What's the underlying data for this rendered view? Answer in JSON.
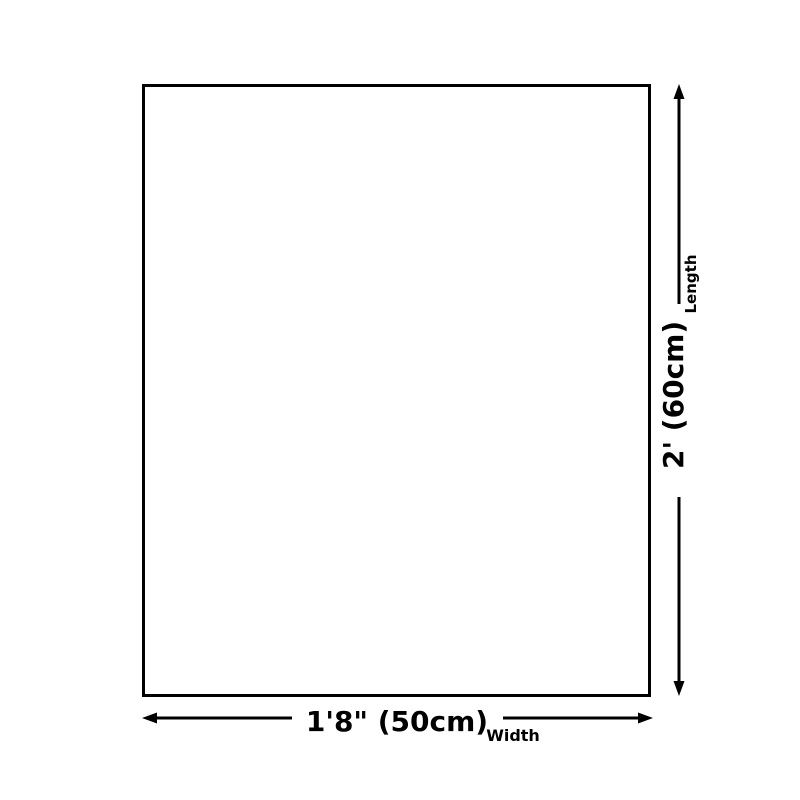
{
  "page": {
    "background_color": "#ffffff"
  },
  "diagram": {
    "type": "product-dimension-diagram",
    "line_color": "#000000",
    "shape": {
      "kind": "rectangle",
      "fill": "#ffffff",
      "border_color": "#000000"
    },
    "length_dimension": {
      "label": "Length",
      "value": "2' (60cm)",
      "orientation": "vertical"
    },
    "width_dimension": {
      "label": "Width",
      "value": "1'8\" (50cm)",
      "orientation": "horizontal"
    }
  }
}
